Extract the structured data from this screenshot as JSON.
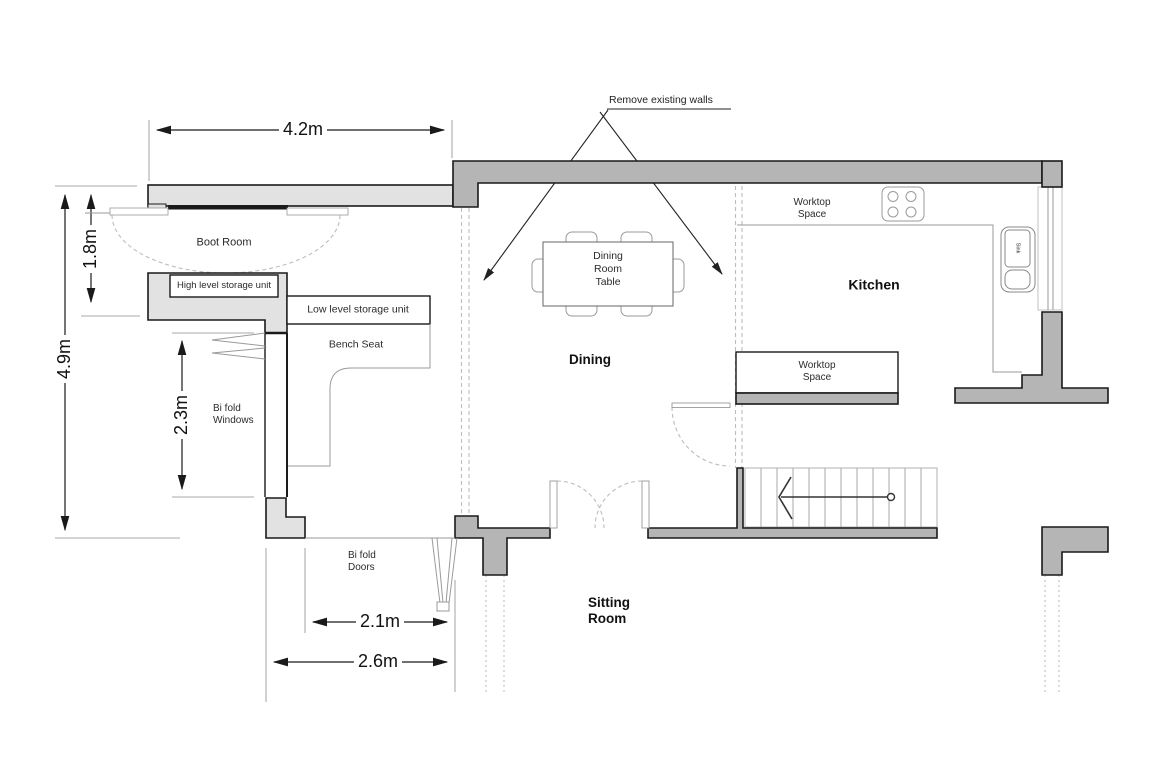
{
  "annotation": {
    "remove_walls": "Remove existing walls"
  },
  "dimensions": {
    "top_width": "4.2m",
    "boot_room_depth": "1.8m",
    "left_total_height": "4.9m",
    "bifold_windows_height": "2.3m",
    "bifold_doors_width": "2.1m",
    "bifold_opening_width": "2.6m"
  },
  "rooms": {
    "boot_room": "Boot Room",
    "dining": "Dining",
    "kitchen": "Kitchen",
    "sitting_room": "Sitting\nRoom"
  },
  "features": {
    "high_storage": "High level storage unit",
    "low_storage": "Low level storage unit",
    "bench_seat": "Bench Seat",
    "bifold_windows": "Bi fold\nWindows",
    "bifold_doors": "Bi fold\nDoors",
    "dining_table": "Dining\nRoom\nTable",
    "worktop_space_top": "Worktop\nSpace",
    "worktop_space_mid": "Worktop\nSpace",
    "sink": "Sink"
  },
  "colors": {
    "wall_light": "#e2e2e2",
    "wall_dark": "#b5b5b5",
    "outline": "#1a1a1a",
    "thin_line": "#9a9a9a",
    "dashed": "#bdbdbd"
  }
}
